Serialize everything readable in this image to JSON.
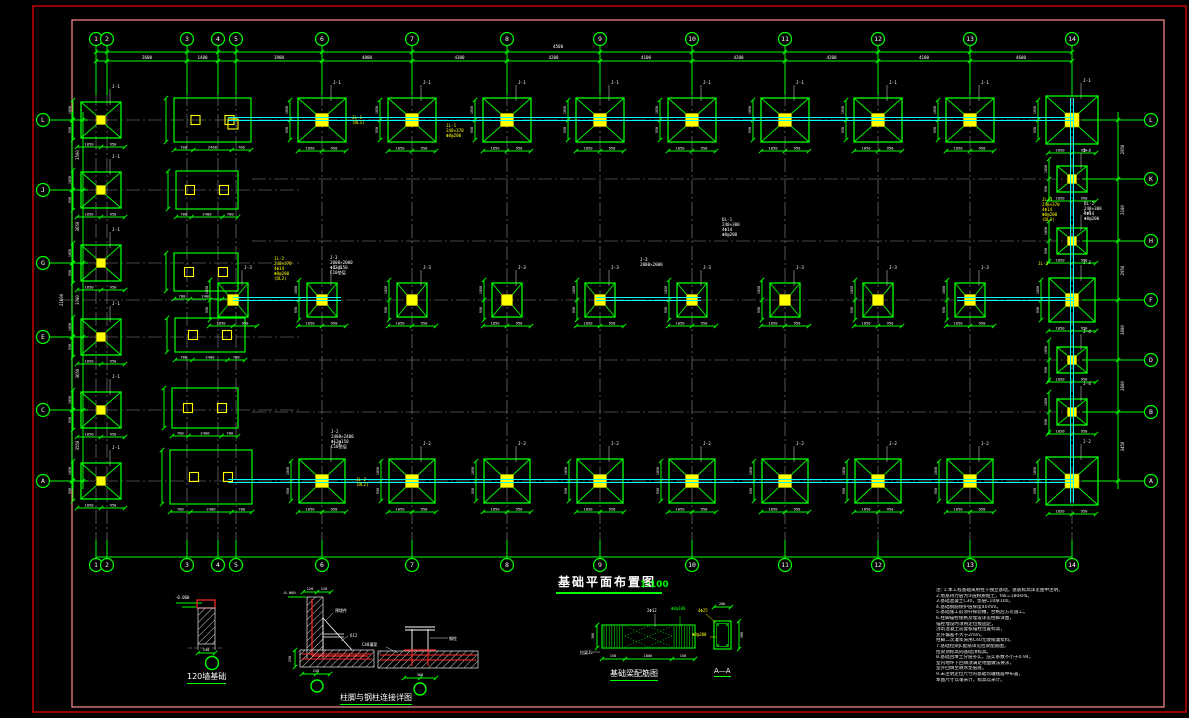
{
  "meta": {
    "sheet_title": "基础平面布置图",
    "scale_label": "1:100"
  },
  "colors": {
    "line_green": "#00ff00",
    "beam_cyan": "#00ffff",
    "accent_yellow": "#ffff00",
    "text_white": "#ffffff",
    "grid_gray": "#8c8c8c",
    "border_outer_red": "#d40000",
    "border_inner_pink": "#ff9090",
    "rebar_red": "#ff2a2a"
  },
  "plan": {
    "axes_v": {
      "labels": [
        "1",
        "2",
        "3",
        "4",
        "5",
        "6",
        "7",
        "8",
        "9",
        "10",
        "11",
        "12",
        "13",
        "14"
      ],
      "xs": [
        96,
        107,
        187,
        218,
        236,
        322,
        412,
        507,
        600,
        692,
        785,
        878,
        970,
        1072
      ],
      "dims": [
        "500",
        "3600",
        "1400",
        "800",
        "3900",
        "4000",
        "4300",
        "4200",
        "4100",
        "4200",
        "4200",
        "4100",
        "4600"
      ]
    },
    "axes_h_left": {
      "labels": [
        "L",
        "J",
        "G",
        "E",
        "C",
        "A"
      ],
      "ys": [
        120,
        190,
        263,
        337,
        410,
        481
      ],
      "dims": [
        "3500",
        "3650",
        "3700",
        "3650",
        "3550"
      ],
      "total_dim": "21600"
    },
    "axes_h_right": {
      "labels": [
        "L",
        "K",
        "H",
        "F",
        "D",
        "B",
        "A"
      ],
      "ys": [
        120,
        179,
        241,
        300,
        360,
        412,
        481
      ],
      "dims": [
        "2950",
        "3100",
        "2950",
        "3000",
        "2600",
        "3450"
      ]
    },
    "footing_dims": [
      "1050",
      "950"
    ],
    "rect_dims": [
      "700",
      "2400",
      "700"
    ],
    "footing_labels": {
      "top": "J-1",
      "middle": "J-3",
      "bottom": "J-2",
      "right_small": "J-4",
      "left": "J-1"
    },
    "annotations": [
      {
        "x": 553,
        "y": 48,
        "c": "#ffffff",
        "lines": [
          "4500"
        ]
      },
      {
        "x": 352,
        "y": 119,
        "c": "#ffff00",
        "lines": [
          "JL-1",
          "(DL1)"
        ]
      },
      {
        "x": 446,
        "y": 127,
        "c": "#ffff00",
        "lines": [
          "JL-1",
          "240×370",
          "Φ8@200"
        ]
      },
      {
        "x": 722,
        "y": 221,
        "c": "#ffffff",
        "lines": [
          "DL-1",
          "240×300",
          "4Φ14",
          "Φ8@200"
        ]
      },
      {
        "x": 274,
        "y": 260,
        "c": "#ffff00",
        "lines": [
          "JL-2",
          "240×370",
          "4Φ14",
          "Φ8@200",
          "(DL2)"
        ]
      },
      {
        "x": 330,
        "y": 259,
        "c": "#ffffff",
        "lines": [
          "J-3",
          "2000×2000",
          "Φ12@150",
          "C10垫层"
        ]
      },
      {
        "x": 640,
        "y": 261,
        "c": "#ffffff",
        "lines": [
          "J-3",
          "2000×2000"
        ]
      },
      {
        "x": 1042,
        "y": 201,
        "c": "#ffff00",
        "lines": [
          "JL-3",
          "240×370",
          "4Φ14",
          "Φ8@200",
          "(DL3)"
        ]
      },
      {
        "x": 1084,
        "y": 205,
        "c": "#ffffff",
        "lines": [
          "DL-2",
          "240×300",
          "4Φ14",
          "Φ8@200"
        ]
      },
      {
        "x": 1038,
        "y": 265,
        "c": "#ffff00",
        "lines": [
          "JL-3"
        ]
      },
      {
        "x": 331,
        "y": 433,
        "c": "#ffffff",
        "lines": [
          "J-2",
          "2400×2400",
          "Φ12@150",
          "C10垫层"
        ]
      },
      {
        "x": 356,
        "y": 481,
        "c": "#ffff00",
        "lines": [
          "JL-2",
          "(DL2)"
        ]
      }
    ]
  },
  "details": {
    "d1": {
      "title": "120墙基础",
      "elev": "-0.060",
      "dim_bottom": "240"
    },
    "d2": {
      "title": "柱脚与钢柱连接详图",
      "labels": {
        "plate": "预埋件",
        "gusset": "δ12",
        "col": "钢柱",
        "grout": "C40灌浆",
        "elev": "-0.060"
      },
      "dims": {
        "top1": "120",
        "top2": "120",
        "left": "250",
        "bottom": "240",
        "b2": "300"
      }
    },
    "d3": {
      "title": "基础梁配筋图",
      "section_title": "A—A",
      "labels": {
        "top1": "2Φ12",
        "top2": "Φ8@100",
        "left": "拉梁JL",
        "bar": "4Φ25",
        "stirrup": "Φ8@200"
      },
      "dims": {
        "b1": "150",
        "b2": "1800",
        "b3": "150",
        "h": "300",
        "w": "200"
      }
    }
  },
  "notes": {
    "lines": [
      "注: 1.本工程基础采用柱下独立基础，基底标高详见图中注明。",
      "    2.地基持力层为②层粉质粘土，fak=180kPa。",
      "    3.基础混凝土C30，垫层C10厚100。",
      "    4.基础钢筋保护层厚度40mm。",
      "    5.基础施工前须钎探验槽，合格后方可施工。",
      "    6.柱脚锚栓规格及埋设详见柱脚详图，",
      "      锚栓埋设时须用定位板固定，",
      "      浇筑混凝土前复核锚栓位置标高，",
      "      允许偏差不大于2mm。",
      "      柱脚二次灌浆采用C40无收缩灌浆料。",
      "    7.基础拉梁JL配筋详见拉梁配筋图，",
      "      拉梁顶标高同基础顶标高。",
      "    8.基础回填土分层夯实，压实系数不小于0.94，",
      "      室内地坪下回填须满足地面做法要求，",
      "      室外回填至散水垫层底。",
      "    9.未注明定位尺寸的基础均轴线居中布置，",
      "      本图尺寸以毫米计，标高以米计。"
    ]
  }
}
